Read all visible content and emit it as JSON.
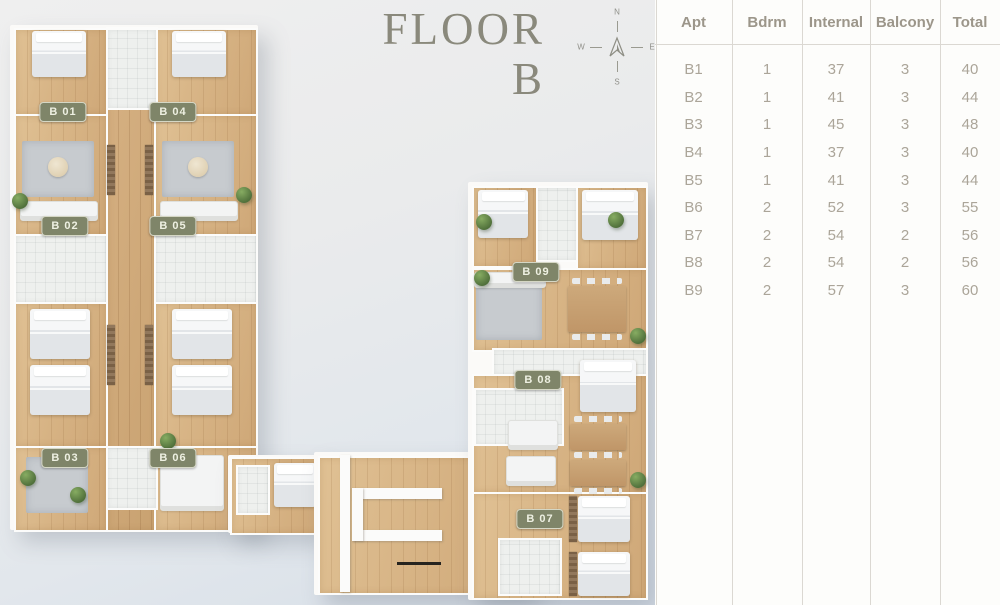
{
  "title": {
    "line1": "FLOOR",
    "line2": "B"
  },
  "compass": {
    "north": "N",
    "east": "E",
    "south": "S",
    "west": "W"
  },
  "plan": {
    "floor_name": "Floor B",
    "units": [
      {
        "label": "B 01",
        "x": 63,
        "y": 112
      },
      {
        "label": "B 04",
        "x": 173,
        "y": 112
      },
      {
        "label": "B 02",
        "x": 65,
        "y": 226
      },
      {
        "label": "B 05",
        "x": 173,
        "y": 226
      },
      {
        "label": "B 03",
        "x": 65,
        "y": 458
      },
      {
        "label": "B 06",
        "x": 173,
        "y": 458
      },
      {
        "label": "B 09",
        "x": 536,
        "y": 272
      },
      {
        "label": "B 08",
        "x": 538,
        "y": 380
      },
      {
        "label": "B 07",
        "x": 540,
        "y": 519
      }
    ]
  },
  "table": {
    "headers": [
      "Apt",
      "Bdrm",
      "Internal",
      "Balcony",
      "Total"
    ],
    "rows": [
      [
        "B1",
        "1",
        "37",
        "3",
        "40"
      ],
      [
        "B2",
        "1",
        "41",
        "3",
        "44"
      ],
      [
        "B3",
        "1",
        "45",
        "3",
        "48"
      ],
      [
        "B4",
        "1",
        "37",
        "3",
        "40"
      ],
      [
        "B5",
        "1",
        "41",
        "3",
        "44"
      ],
      [
        "B6",
        "2",
        "52",
        "3",
        "55"
      ],
      [
        "B7",
        "2",
        "54",
        "2",
        "56"
      ],
      [
        "B8",
        "2",
        "54",
        "2",
        "56"
      ],
      [
        "B9",
        "2",
        "57",
        "3",
        "60"
      ]
    ]
  },
  "colors": {
    "unit_label_bg": "#7f8569",
    "title": "#8a897c",
    "table_header": "#9c968a",
    "table_value": "#aba599",
    "table_line": "#dbd8d2"
  }
}
